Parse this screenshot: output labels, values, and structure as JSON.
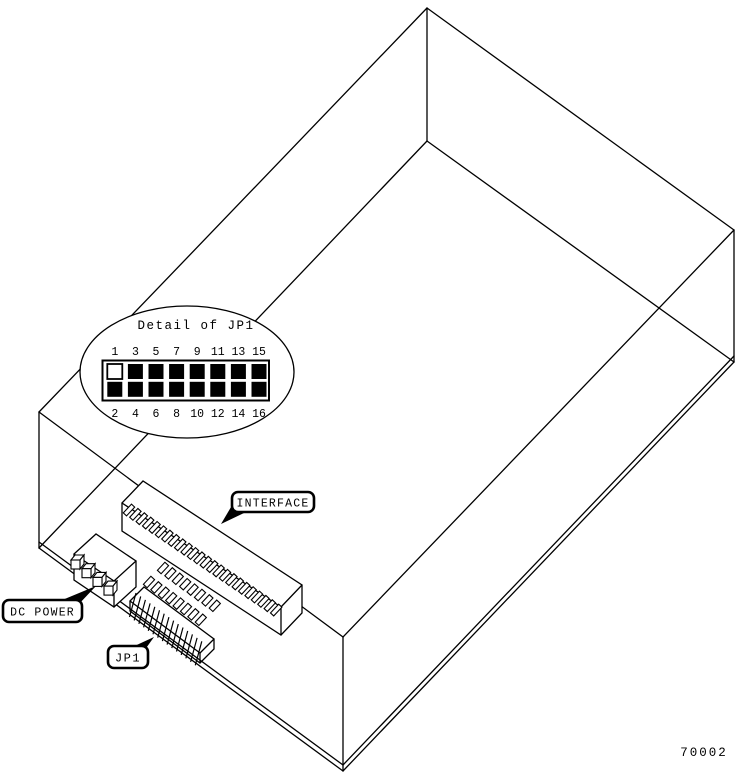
{
  "figure_number": "70002",
  "callouts": {
    "dc_power": "DC POWER",
    "interface": "INTERFACE",
    "jp1": "JP1"
  },
  "jp1_detail": {
    "title": "Detail of JP1",
    "top_row_pins": [
      "1",
      "3",
      "5",
      "7",
      "9",
      "11",
      "13",
      "15"
    ],
    "bottom_row_pins": [
      "2",
      "4",
      "6",
      "8",
      "10",
      "12",
      "14",
      "16"
    ],
    "open_pins": [
      "1"
    ]
  },
  "connectors": {
    "dc_power_pin_count": 4,
    "interface_contact_rows": 1,
    "jp1_pin_count": 16
  },
  "colors": {
    "line": "#000000",
    "background": "#ffffff"
  }
}
